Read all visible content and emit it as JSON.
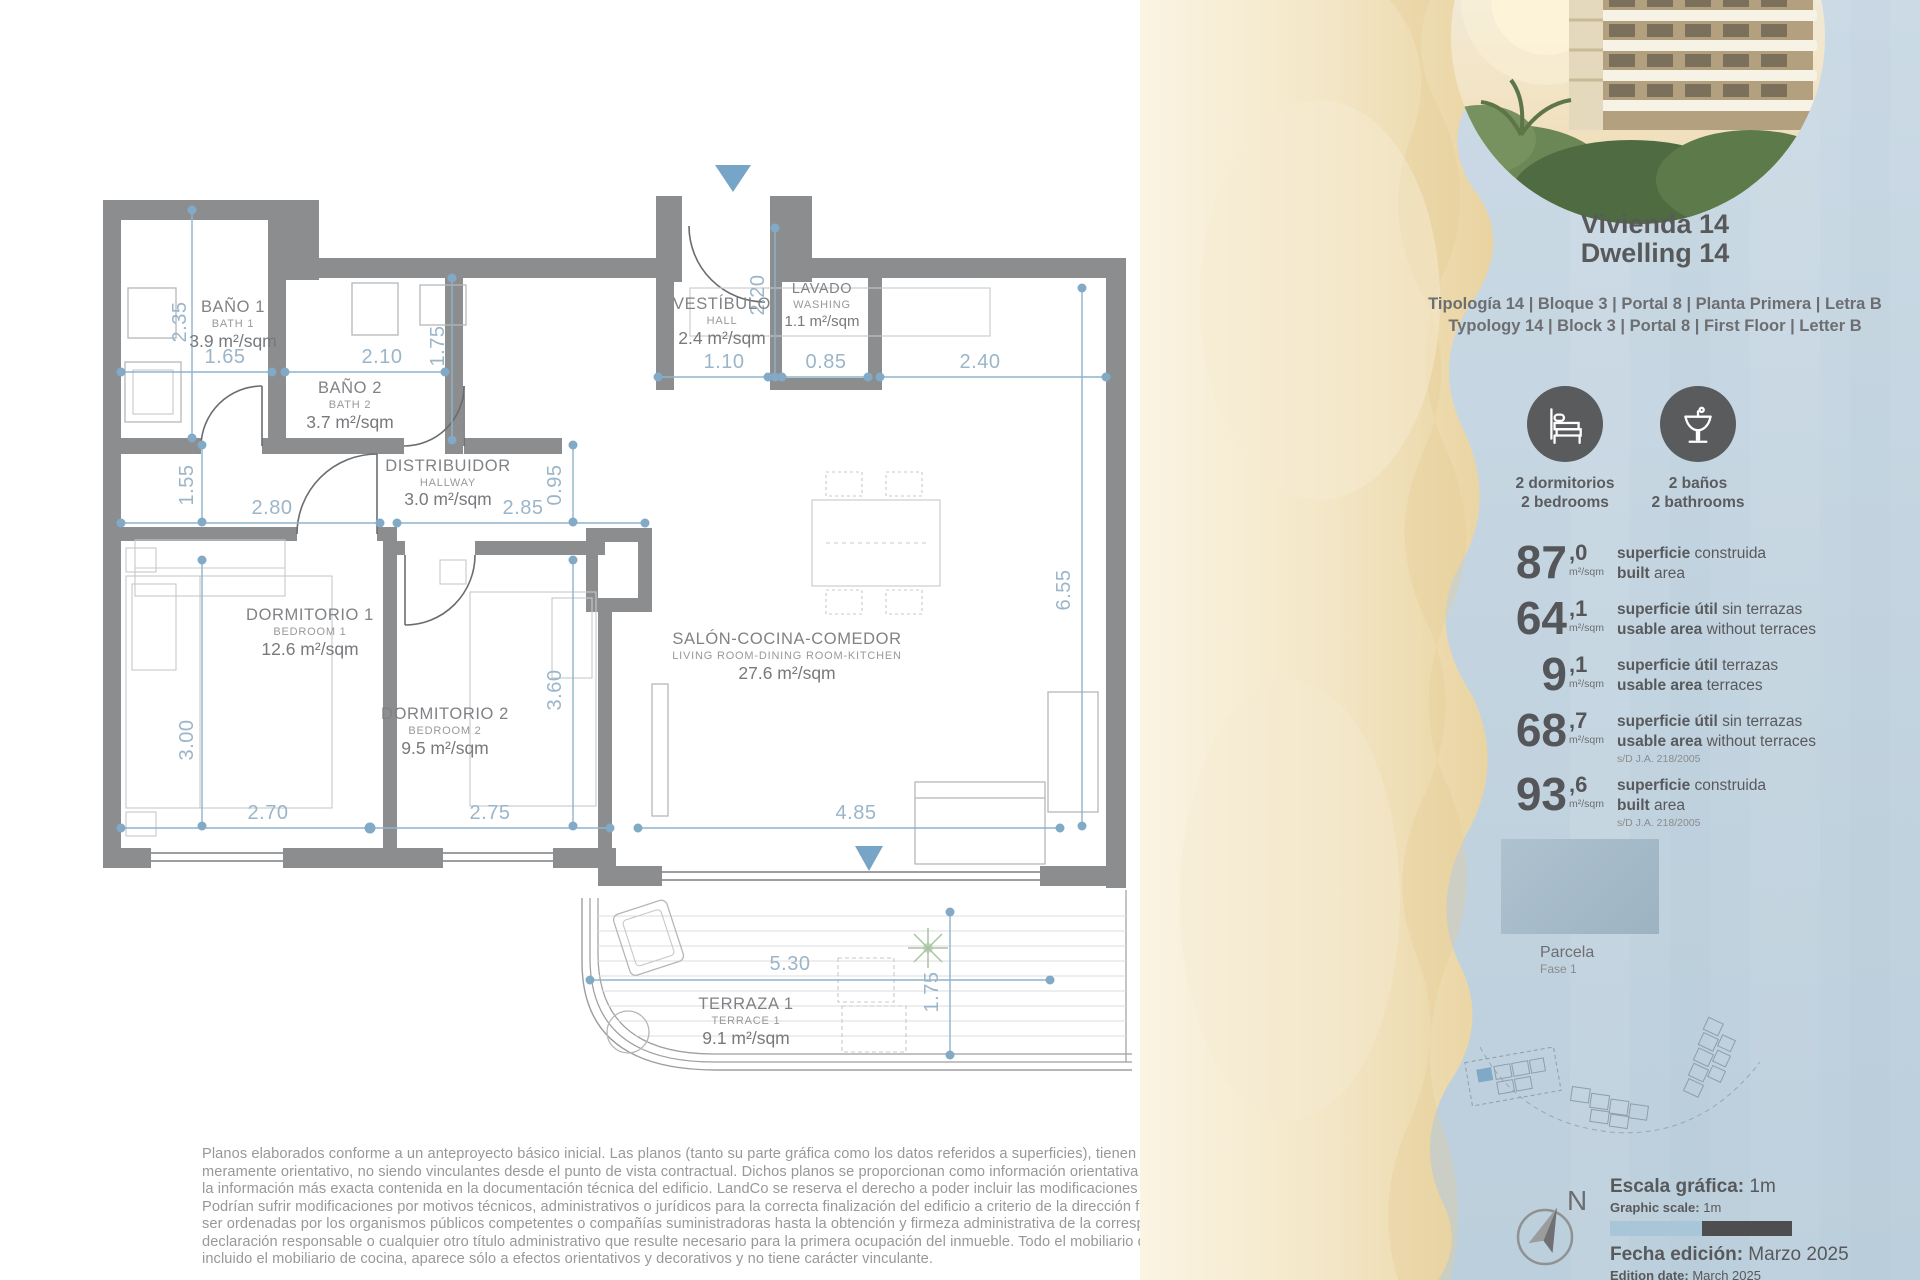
{
  "plan": {
    "rooms": [
      {
        "es": "BAÑO 1",
        "en": "BATH 1",
        "area": "3.9 m²/sqm"
      },
      {
        "es": "BAÑO 2",
        "en": "BATH 2",
        "area": "3.7 m²/sqm"
      },
      {
        "es": "VESTÍBULO",
        "en": "HALL",
        "area": "2.4 m²/sqm"
      },
      {
        "es": "LAVADO",
        "en": "WASHING",
        "area": "1.1 m²/sqm"
      },
      {
        "es": "DISTRIBUIDOR",
        "en": "HALLWAY",
        "area": "3.0 m²/sqm"
      },
      {
        "es": "DORMITORIO 1",
        "en": "BEDROOM 1",
        "area": "12.6 m²/sqm"
      },
      {
        "es": "DORMITORIO 2",
        "en": "BEDROOM 2",
        "area": "9.5 m²/sqm"
      },
      {
        "es": "SALÓN-COCINA-COMEDOR",
        "en": "LIVING ROOM-DINING ROOM-KITCHEN",
        "area": "27.6 m²/sqm"
      },
      {
        "es": "TERRAZA 1",
        "en": "TERRACE 1",
        "area": "9.1 m²/sqm"
      }
    ],
    "dims": [
      "2.35",
      "1.65",
      "2.10",
      "1.75",
      "2.20",
      "1.10",
      "0.85",
      "2.40",
      "1.55",
      "2.80",
      "2.85",
      "0.95",
      "3.00",
      "3.60",
      "6.55",
      "2.70",
      "2.75",
      "4.85",
      "5.30",
      "1.75"
    ]
  },
  "sidebar": {
    "title_es": "Vivienda 14",
    "title_en": "Dwelling 14",
    "typology_es": "Tipología 14  |  Bloque 3  |  Portal 8  |  Planta Primera  |  Letra B",
    "typology_en": "Typology 14  |  Block 3  |  Portal 8  |  First Floor  |  Letter B",
    "features": [
      {
        "es": "2 dormitorios",
        "en": "2 bedrooms"
      },
      {
        "es": "2 baños",
        "en": "2 bathrooms"
      }
    ],
    "stats": [
      {
        "int": "87",
        "dec": ",0",
        "unit": "m²/sqm",
        "es_b": "superficie",
        "es_r": " construida",
        "en_b": "built",
        "en_r": " area",
        "note": ""
      },
      {
        "int": "64",
        "dec": ",1",
        "unit": "m²/sqm",
        "es_b": "superficie útil",
        "es_r": " sin terrazas",
        "en_b": "usable area",
        "en_r": " without terraces",
        "note": ""
      },
      {
        "int": "9",
        "dec": ",1",
        "unit": "m²/sqm",
        "es_b": "superficie útil",
        "es_r": " terrazas",
        "en_b": "usable area",
        "en_r": " terraces",
        "note": ""
      },
      {
        "int": "68",
        "dec": ",7",
        "unit": "m²/sqm",
        "es_b": "superficie útil",
        "es_r": " sin terrazas",
        "en_b": "usable area",
        "en_r": " without terraces",
        "note": "s/D J.A. 218/2005"
      },
      {
        "int": "93",
        "dec": ",6",
        "unit": "m²/sqm",
        "es_b": "superficie",
        "es_r": " construida",
        "en_b": "built",
        "en_r": " area",
        "note": "s/D J.A. 218/2005"
      }
    ],
    "parcela": {
      "title": "Parcela",
      "subtitle": "Fase 1"
    },
    "compass_n": "N",
    "scale": {
      "es_b": "Escala gráfica:",
      "es_v": " 1m",
      "en_b": "Graphic scale:",
      "en_v": " 1m"
    },
    "edition": {
      "es_b": "Fecha edición:",
      "es_v": " Marzo 2025",
      "en_b": "Edition date:",
      "en_v": " March 2025"
    }
  },
  "colors": {
    "accent_blue": "#82a9c6",
    "wall_gray": "#8c8d8f",
    "sand": "#ecd9ad",
    "sea_blue": "#c7d7e2",
    "highlight_unit": "#7fa9c6"
  },
  "disclaimer": "Planos elaborados conforme a un anteproyecto básico inicial. Las planos (tanto su parte gráfica como los datos referidos a superficies), tienen carácter meramente orientativo, no siendo vinculantes desde el punto de vista contractual. Dichos planos se proporcionan como información orientativa y sin perjuicio de la información más exacta contenida en la documentación técnica del edificio. LandCo se reserva el derecho a poder incluir las modificaciones necesarias. Podrían sufrir modificaciones por motivos técnicos, administrativos o jurídicos para la correcta finalización del edificio a criterio de la dirección facultativa y/o por ser ordenadas por los organismos públicos competentes o compañías suministradoras hasta la obtención y firmeza administrativa de la correspondiente licencia, declaración responsable o cualquier otro título administrativo que resulte necesario para la primera ocupación del inmueble. Todo el mobiliario que se muestra, incluido el mobiliario de cocina, aparece sólo a efectos orientativos y decorativos y no tiene carácter vinculante."
}
